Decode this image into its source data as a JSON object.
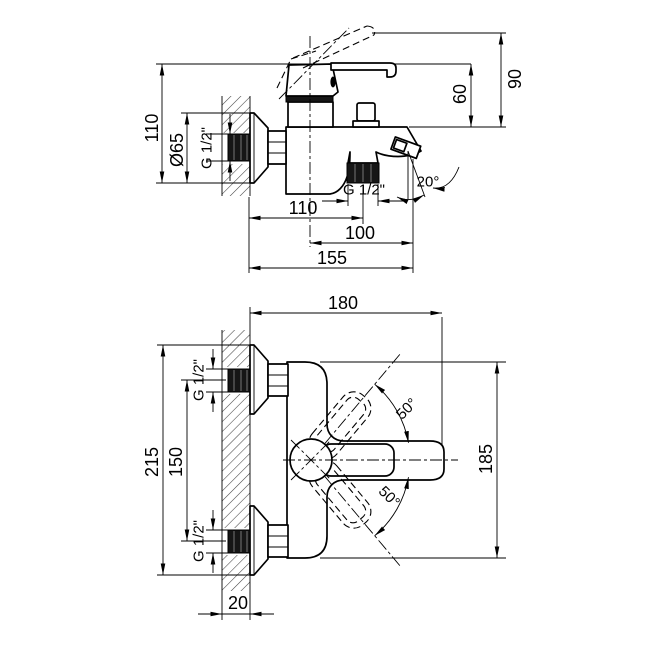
{
  "colors": {
    "line": "#000000",
    "background": "#ffffff",
    "thread_fill": "#161616"
  },
  "top_view": {
    "dim_overall_height": "110",
    "dim_flange_diameter": "Ø65",
    "dim_inlet_thread": "G 1/2\"",
    "dim_handle_raised_height": "90",
    "dim_handle_height": "60",
    "dim_shower_outlet_thread": "G 1/2\"",
    "dim_spout_angle": "20°",
    "dim_wall_to_outlet_axis": "110",
    "dim_body_axis_to_spout_tip": "100",
    "dim_wall_to_spout_tip": "155"
  },
  "front_view": {
    "dim_overall_width": "180",
    "dim_top_inlet_thread": "G 1/2\"",
    "dim_flange_span_height": "215",
    "dim_inlet_spacing": "150",
    "dim_bottom_inlet_thread": "G 1/2\"",
    "dim_body_height": "185",
    "dim_handle_swing_up": "50°",
    "dim_handle_swing_down": "50°",
    "dim_wall_thickness": "20"
  }
}
